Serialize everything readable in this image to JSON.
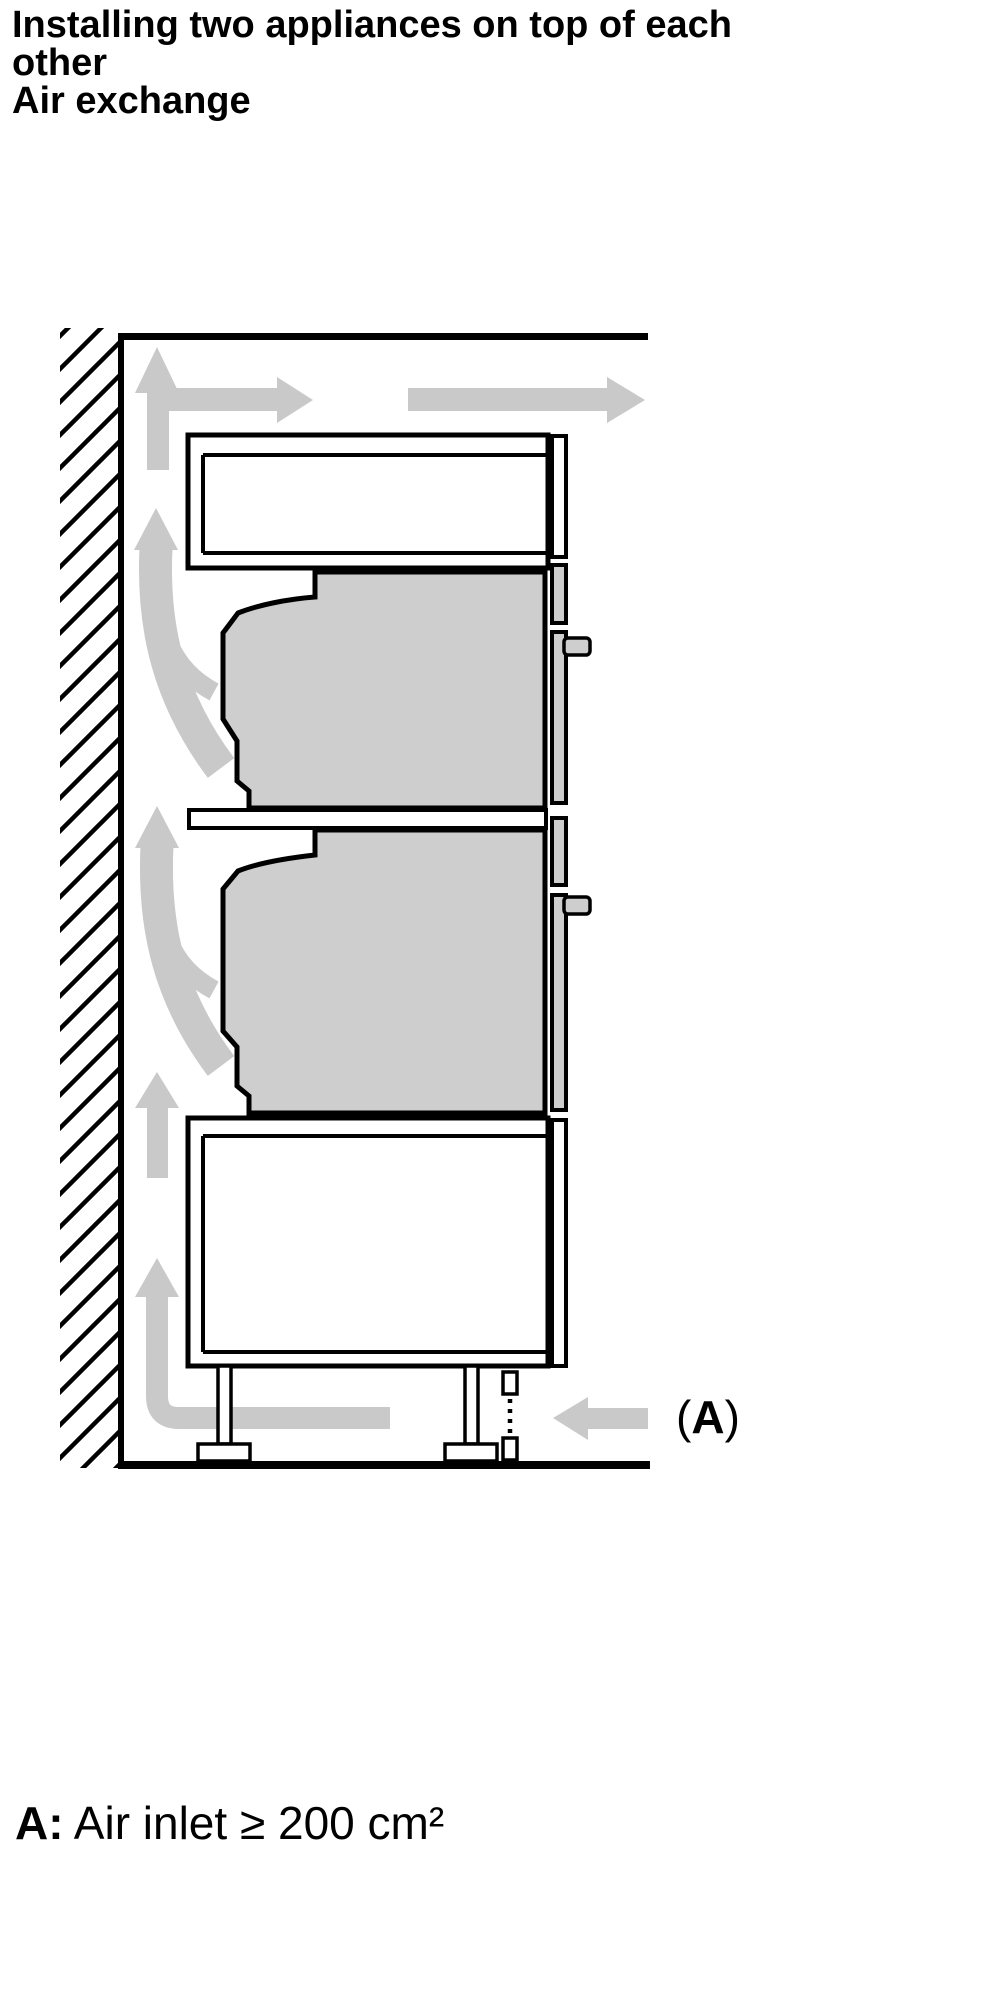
{
  "heading": {
    "lines": [
      "Installing two appliances on top of each",
      "other",
      "Air exchange"
    ]
  },
  "diagram": {
    "inlet_label": {
      "open": "(",
      "letter": "A",
      "close": ")"
    },
    "icons": [
      "wall-hatch",
      "up-arrow",
      "right-arrow",
      "curved-flow-arrow",
      "corner-intake-arrow",
      "air-inlet-left-arrow",
      "oven-handle"
    ]
  },
  "caption": {
    "prefix": "A:",
    "text": " Air inlet ≥ 200 cm²"
  },
  "colors": {
    "arrow_gray": "#c9c9c9",
    "appliance_gray": "#cecece",
    "ink": "#000000",
    "paper": "#ffffff"
  }
}
